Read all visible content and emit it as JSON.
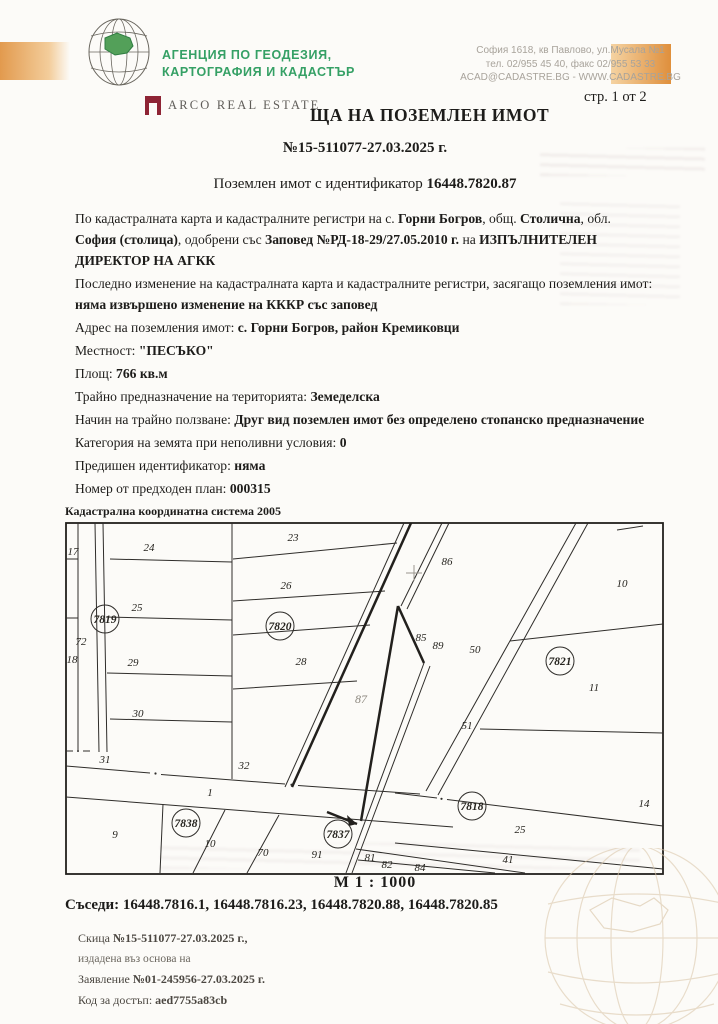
{
  "header": {
    "agency_line1": "АГЕНЦИЯ ПО ГЕОДЕЗИЯ,",
    "agency_line2": "КАРТОГРАФИЯ И КАДАСТЪР",
    "address_line1": "София 1618, кв Павлово, ул.Мусала №1",
    "address_line2": "тел. 02/955 45 40, факс 02/955 53 33",
    "address_line3": "ACAD@CADASTRE.BG - WWW.CADASTRE.BG",
    "page_label": "стр. 1 от 2",
    "arco_label": "ARCO REAL ESTATE"
  },
  "title": {
    "visible": "ЩА НА ПОЗЕМЛЕН ИМОТ",
    "number": "№15-511077-27.03.2025 г."
  },
  "subject_runs": [
    {
      "t": "Поземлен имот с идентификатор "
    },
    {
      "t": "16448.7820.87",
      "b": true
    }
  ],
  "body": {
    "p1": [
      {
        "t": "По кадастралната карта и кадастралните регистри на с. "
      },
      {
        "t": "Горни Богров",
        "b": true
      },
      {
        "t": ", общ. "
      },
      {
        "t": "Столична",
        "b": true
      },
      {
        "t": ", обл. "
      },
      {
        "t": "София (столица)",
        "b": true
      },
      {
        "t": ", одобрени със "
      },
      {
        "t": "Заповед №РД-18-29/27.05.2010 г.",
        "b": true
      },
      {
        "t": " на "
      },
      {
        "t": "ИЗПЪЛНИТЕЛЕН ДИРЕКТОР НА АГКК",
        "b": true
      }
    ],
    "p2": [
      {
        "t": "Последно изменение на кадастралната карта и кадастралните регистри, засягащо поземления имот: "
      },
      {
        "t": "няма извършено изменение на КККР със заповед",
        "b": true
      }
    ],
    "p3": [
      {
        "t": "Адрес на поземления имот: "
      },
      {
        "t": "с. Горни Богров, район Кремиковци",
        "b": true
      }
    ],
    "p4": [
      {
        "t": "Местност: "
      },
      {
        "t": "\"ПЕСЪКО\"",
        "b": true
      }
    ],
    "p5": [
      {
        "t": "Площ: "
      },
      {
        "t": "766 кв.м",
        "b": true
      }
    ],
    "p6": [
      {
        "t": "Трайно предназначение на територията: "
      },
      {
        "t": "Земеделска",
        "b": true
      }
    ],
    "p7": [
      {
        "t": "Начин на трайно ползване: "
      },
      {
        "t": "Друг вид поземлен имот без определено стопанско предназначение",
        "b": true
      }
    ],
    "p8": [
      {
        "t": "Категория на земята при неполивни условия: "
      },
      {
        "t": "0",
        "b": true
      }
    ],
    "p9": [
      {
        "t": "Предишен идентификатор: "
      },
      {
        "t": "няма",
        "b": true
      }
    ],
    "p10": [
      {
        "t": "Номер от предходен план: "
      },
      {
        "t": "000315",
        "b": true
      }
    ]
  },
  "map": {
    "caption": "Кадастрална координатна система 2005",
    "scale_label": "М 1 : 1000",
    "labels": [
      {
        "t": "17",
        "x": 8,
        "y": 34
      },
      {
        "t": "18",
        "x": 7,
        "y": 142
      },
      {
        "t": "24",
        "x": 84,
        "y": 30
      },
      {
        "t": "25",
        "x": 72,
        "y": 90
      },
      {
        "t": "29",
        "x": 68,
        "y": 145
      },
      {
        "t": "30",
        "x": 73,
        "y": 196
      },
      {
        "t": "31",
        "x": 40,
        "y": 242
      },
      {
        "t": "72",
        "x": 16,
        "y": 124
      },
      {
        "t": "23",
        "x": 228,
        "y": 20
      },
      {
        "t": "26",
        "x": 221,
        "y": 68
      },
      {
        "t": "28",
        "x": 236,
        "y": 144
      },
      {
        "t": "32",
        "x": 179,
        "y": 248
      },
      {
        "t": "1",
        "x": 145,
        "y": 275
      },
      {
        "t": "86",
        "x": 382,
        "y": 44
      },
      {
        "t": "85",
        "x": 356,
        "y": 120
      },
      {
        "t": "89",
        "x": 373,
        "y": 128
      },
      {
        "t": "50",
        "x": 410,
        "y": 132
      },
      {
        "t": "51",
        "x": 402,
        "y": 208
      },
      {
        "t": "87",
        "x": 296,
        "y": 182,
        "c": "dim"
      },
      {
        "t": "10",
        "x": 557,
        "y": 66
      },
      {
        "t": "11",
        "x": 529,
        "y": 170
      },
      {
        "t": "14",
        "x": 579,
        "y": 286
      },
      {
        "t": "9",
        "x": 50,
        "y": 317
      },
      {
        "t": "10",
        "x": 145,
        "y": 326
      },
      {
        "t": "70",
        "x": 198,
        "y": 335
      },
      {
        "t": "91",
        "x": 252,
        "y": 337
      },
      {
        "t": "81",
        "x": 305,
        "y": 340
      },
      {
        "t": "82",
        "x": 322,
        "y": 347
      },
      {
        "t": "84",
        "x": 355,
        "y": 350
      },
      {
        "t": "25",
        "x": 455,
        "y": 312
      },
      {
        "t": "41",
        "x": 443,
        "y": 342
      }
    ],
    "circles": [
      {
        "t": "7819",
        "x": 40,
        "y": 98
      },
      {
        "t": "7820",
        "x": 215,
        "y": 105
      },
      {
        "t": "7821",
        "x": 495,
        "y": 140
      },
      {
        "t": "7818",
        "x": 407,
        "y": 285
      },
      {
        "t": "7837",
        "x": 273,
        "y": 313
      },
      {
        "t": "7838",
        "x": 121,
        "y": 302
      }
    ]
  },
  "neighbors_runs": [
    {
      "t": "Съседи: ",
      "b": true
    },
    {
      "t": "16448.7816.1, 16448.7816.23, 16448.7820.88, 16448.7820.85",
      "b": true
    }
  ],
  "footer": {
    "f1": [
      {
        "t": "Скица "
      },
      {
        "t": "№15-511077-27.03.2025 г.,",
        "b": true
      }
    ],
    "f2": [
      {
        "t": "издадена въз основа на"
      }
    ],
    "f3": [
      {
        "t": "Заявление "
      },
      {
        "t": "№01-245956-27.03.2025 г.",
        "b": true
      }
    ],
    "f4": [
      {
        "t": "Код за достъп: "
      },
      {
        "t": "aed7755a83cb",
        "b": true
      }
    ]
  }
}
